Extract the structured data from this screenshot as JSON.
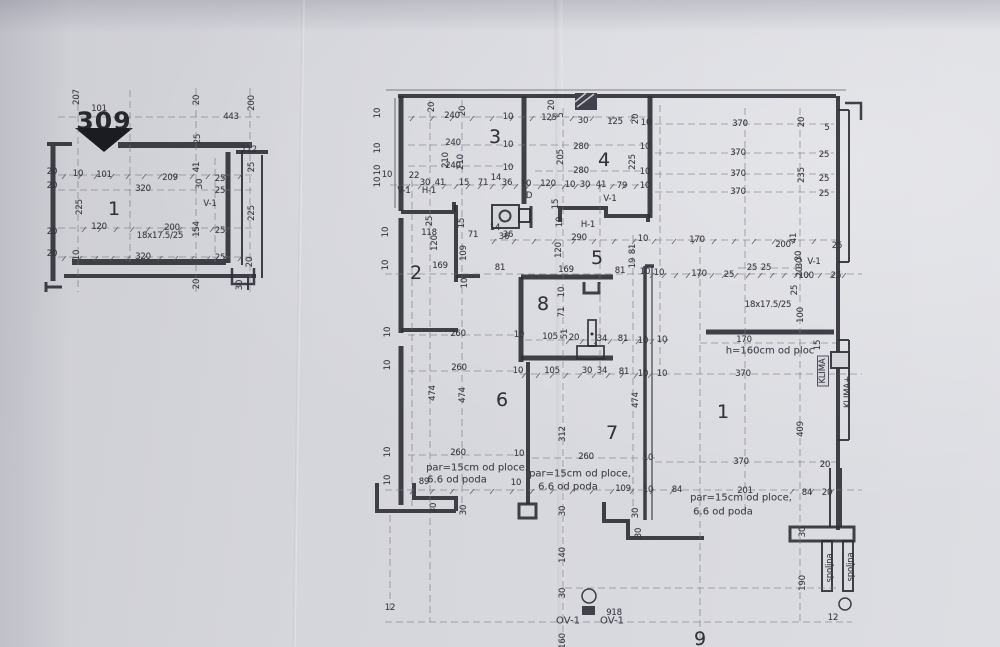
{
  "meta": {
    "document_type": "scanned architectural floor plan",
    "section_mark": "309",
    "paper_color": "#d5d6db",
    "ink_color": "#2d2d35"
  },
  "small_plan": {
    "room_numbers": [
      "1"
    ],
    "shaft_label": "V-1",
    "beam_note": "18x17.5/25"
  },
  "main_plan": {
    "room_numbers": [
      "1",
      "2",
      "3",
      "4",
      "5",
      "6",
      "7",
      "8",
      "9"
    ],
    "vent_labels": [
      "V-1",
      "H-1",
      "OV-1",
      "D"
    ],
    "notes": [
      "par=15cm od ploce.",
      "6.6 od poda",
      "h=160cm od ploc",
      "18x17.5/25"
    ],
    "equipment": [
      "KLIMA",
      "KLIMA+",
      "spoljna"
    ]
  },
  "labels": [
    {
      "t": "207",
      "x": 77,
      "y": 97,
      "r": 1
    },
    {
      "t": "101",
      "x": 99,
      "y": 109
    },
    {
      "t": "309",
      "x": 104,
      "y": 121,
      "k": "b"
    },
    {
      "t": "20",
      "x": 197,
      "y": 100,
      "r": 1
    },
    {
      "t": "443",
      "x": 231,
      "y": 117
    },
    {
      "t": "200",
      "x": 252,
      "y": 103,
      "r": 1
    },
    {
      "t": "25",
      "x": 198,
      "y": 139,
      "r": 1
    },
    {
      "t": "112",
      "x": 249,
      "y": 150
    },
    {
      "t": "25",
      "x": 252,
      "y": 167,
      "r": 1
    },
    {
      "t": "41",
      "x": 197,
      "y": 167,
      "r": 1
    },
    {
      "t": "20",
      "x": 52,
      "y": 172
    },
    {
      "t": "10",
      "x": 78,
      "y": 174
    },
    {
      "t": "101",
      "x": 104,
      "y": 175
    },
    {
      "t": "209",
      "x": 170,
      "y": 178
    },
    {
      "t": "25",
      "x": 220,
      "y": 179
    },
    {
      "t": "30",
      "x": 200,
      "y": 184,
      "r": 1
    },
    {
      "t": "20",
      "x": 52,
      "y": 186
    },
    {
      "t": "320",
      "x": 143,
      "y": 189
    },
    {
      "t": "25",
      "x": 220,
      "y": 191
    },
    {
      "t": "V-1",
      "x": 210,
      "y": 204
    },
    {
      "t": "225",
      "x": 80,
      "y": 207,
      "r": 1
    },
    {
      "t": "1",
      "x": 114,
      "y": 209,
      "k": "r"
    },
    {
      "t": "225",
      "x": 252,
      "y": 213,
      "r": 1
    },
    {
      "t": "20",
      "x": 52,
      "y": 232
    },
    {
      "t": "120",
      "x": 99,
      "y": 227
    },
    {
      "t": "200",
      "x": 172,
      "y": 228
    },
    {
      "t": "154",
      "x": 197,
      "y": 229,
      "r": 1
    },
    {
      "t": "18x17.5/25",
      "x": 160,
      "y": 236
    },
    {
      "t": "25",
      "x": 220,
      "y": 231
    },
    {
      "t": "20",
      "x": 52,
      "y": 254
    },
    {
      "t": "10",
      "x": 77,
      "y": 255,
      "r": 1
    },
    {
      "t": "320",
      "x": 143,
      "y": 257
    },
    {
      "t": "25",
      "x": 220,
      "y": 258
    },
    {
      "t": "20",
      "x": 250,
      "y": 262,
      "r": 1
    },
    {
      "t": "20",
      "x": 197,
      "y": 284,
      "r": 1
    },
    {
      "t": "30",
      "x": 240,
      "y": 285,
      "r": 1
    },
    {
      "t": "10",
      "x": 378,
      "y": 113,
      "r": 1
    },
    {
      "t": "10",
      "x": 378,
      "y": 148,
      "r": 1
    },
    {
      "t": "10",
      "x": 378,
      "y": 170,
      "r": 1
    },
    {
      "t": "10",
      "x": 378,
      "y": 182,
      "r": 1
    },
    {
      "t": "20",
      "x": 432,
      "y": 107,
      "r": 1
    },
    {
      "t": "240",
      "x": 452,
      "y": 116
    },
    {
      "t": "20",
      "x": 463,
      "y": 111,
      "r": 1
    },
    {
      "t": "10",
      "x": 508,
      "y": 117
    },
    {
      "t": "20",
      "x": 552,
      "y": 105,
      "r": 1
    },
    {
      "t": "125",
      "x": 549,
      "y": 118
    },
    {
      "t": "5",
      "x": 561,
      "y": 115,
      "r": 1
    },
    {
      "t": "30",
      "x": 583,
      "y": 121
    },
    {
      "t": "125",
      "x": 615,
      "y": 122
    },
    {
      "t": "20",
      "x": 636,
      "y": 119,
      "r": 1
    },
    {
      "t": "10",
      "x": 646,
      "y": 123
    },
    {
      "t": "370",
      "x": 740,
      "y": 124
    },
    {
      "t": "20",
      "x": 802,
      "y": 122,
      "r": 1
    },
    {
      "t": "5",
      "x": 827,
      "y": 128
    },
    {
      "t": "3",
      "x": 495,
      "y": 137,
      "k": "r"
    },
    {
      "t": "240",
      "x": 453,
      "y": 143
    },
    {
      "t": "10",
      "x": 508,
      "y": 145
    },
    {
      "t": "280",
      "x": 581,
      "y": 147
    },
    {
      "t": "10",
      "x": 645,
      "y": 147
    },
    {
      "t": "370",
      "x": 738,
      "y": 153
    },
    {
      "t": "25",
      "x": 824,
      "y": 155
    },
    {
      "t": "4",
      "x": 604,
      "y": 160,
      "k": "r"
    },
    {
      "t": "210",
      "x": 446,
      "y": 160,
      "r": 1
    },
    {
      "t": "240",
      "x": 453,
      "y": 166
    },
    {
      "t": "210",
      "x": 461,
      "y": 162,
      "r": 1
    },
    {
      "t": "10",
      "x": 508,
      "y": 168
    },
    {
      "t": "205",
      "x": 561,
      "y": 157,
      "r": 1
    },
    {
      "t": "225",
      "x": 633,
      "y": 162,
      "r": 1
    },
    {
      "t": "280",
      "x": 581,
      "y": 171
    },
    {
      "t": "10",
      "x": 645,
      "y": 172
    },
    {
      "t": "370",
      "x": 738,
      "y": 174
    },
    {
      "t": "235",
      "x": 802,
      "y": 175,
      "r": 1
    },
    {
      "t": "25",
      "x": 824,
      "y": 179
    },
    {
      "t": "10",
      "x": 387,
      "y": 175
    },
    {
      "t": "22",
      "x": 414,
      "y": 176
    },
    {
      "t": "30",
      "x": 425,
      "y": 183
    },
    {
      "t": "41",
      "x": 440,
      "y": 183
    },
    {
      "t": "15",
      "x": 464,
      "y": 183
    },
    {
      "t": "71",
      "x": 483,
      "y": 183
    },
    {
      "t": "14",
      "x": 496,
      "y": 178
    },
    {
      "t": "36",
      "x": 507,
      "y": 183
    },
    {
      "t": "10",
      "x": 526,
      "y": 184
    },
    {
      "t": "120",
      "x": 548,
      "y": 184
    },
    {
      "t": "10",
      "x": 570,
      "y": 185
    },
    {
      "t": "30",
      "x": 585,
      "y": 185
    },
    {
      "t": "41",
      "x": 601,
      "y": 185
    },
    {
      "t": "79",
      "x": 622,
      "y": 186
    },
    {
      "t": "10",
      "x": 645,
      "y": 186
    },
    {
      "t": "370",
      "x": 738,
      "y": 192
    },
    {
      "t": "25",
      "x": 824,
      "y": 194
    },
    {
      "t": "V-1",
      "x": 404,
      "y": 191
    },
    {
      "t": "H-1",
      "x": 429,
      "y": 191
    },
    {
      "t": "D",
      "x": 529,
      "y": 196
    },
    {
      "t": "V-1",
      "x": 610,
      "y": 199
    },
    {
      "t": "15",
      "x": 556,
      "y": 204,
      "r": 1
    },
    {
      "t": "25",
      "x": 430,
      "y": 221,
      "r": 1
    },
    {
      "t": "15",
      "x": 462,
      "y": 223,
      "r": 1
    },
    {
      "t": "118",
      "x": 429,
      "y": 233
    },
    {
      "t": "71",
      "x": 473,
      "y": 235
    },
    {
      "t": "14",
      "x": 495,
      "y": 228
    },
    {
      "t": "36",
      "x": 508,
      "y": 235
    },
    {
      "t": "10",
      "x": 560,
      "y": 222,
      "r": 1
    },
    {
      "t": "H-1",
      "x": 588,
      "y": 225
    },
    {
      "t": "36",
      "x": 504,
      "y": 237
    },
    {
      "t": "290",
      "x": 579,
      "y": 238
    },
    {
      "t": "10",
      "x": 643,
      "y": 239
    },
    {
      "t": "170",
      "x": 697,
      "y": 240
    },
    {
      "t": "41",
      "x": 794,
      "y": 238,
      "r": 1
    },
    {
      "t": "200",
      "x": 783,
      "y": 245
    },
    {
      "t": "25",
      "x": 837,
      "y": 246
    },
    {
      "t": "30",
      "x": 799,
      "y": 256,
      "r": 1
    },
    {
      "t": "V-1",
      "x": 814,
      "y": 262
    },
    {
      "t": "120",
      "x": 435,
      "y": 243,
      "r": 1
    },
    {
      "t": "109",
      "x": 464,
      "y": 253,
      "r": 1
    },
    {
      "t": "120",
      "x": 559,
      "y": 250,
      "r": 1
    },
    {
      "t": "5",
      "x": 597,
      "y": 258,
      "k": "r"
    },
    {
      "t": "81",
      "x": 633,
      "y": 249,
      "r": 1
    },
    {
      "t": "19",
      "x": 633,
      "y": 263,
      "r": 1
    },
    {
      "t": "2",
      "x": 416,
      "y": 273,
      "k": "r"
    },
    {
      "t": "169",
      "x": 440,
      "y": 266
    },
    {
      "t": "81",
      "x": 500,
      "y": 268
    },
    {
      "t": "169",
      "x": 566,
      "y": 270
    },
    {
      "t": "81",
      "x": 620,
      "y": 271
    },
    {
      "t": "10",
      "x": 645,
      "y": 272
    },
    {
      "t": "10",
      "x": 659,
      "y": 273
    },
    {
      "t": "170",
      "x": 699,
      "y": 274
    },
    {
      "t": "25",
      "x": 729,
      "y": 275
    },
    {
      "t": "25",
      "x": 752,
      "y": 268
    },
    {
      "t": "25",
      "x": 766,
      "y": 268
    },
    {
      "t": "30",
      "x": 800,
      "y": 263,
      "r": 1
    },
    {
      "t": "20",
      "x": 800,
      "y": 272,
      "r": 1
    },
    {
      "t": "100",
      "x": 806,
      "y": 276
    },
    {
      "t": "25",
      "x": 836,
      "y": 276
    },
    {
      "t": "10",
      "x": 465,
      "y": 283,
      "r": 1
    },
    {
      "t": "10",
      "x": 386,
      "y": 232,
      "r": 1
    },
    {
      "t": "10",
      "x": 386,
      "y": 265,
      "r": 1
    },
    {
      "t": "10",
      "x": 388,
      "y": 332,
      "r": 1
    },
    {
      "t": "8",
      "x": 543,
      "y": 304,
      "k": "r"
    },
    {
      "t": "10",
      "x": 562,
      "y": 292,
      "r": 1
    },
    {
      "t": "71",
      "x": 562,
      "y": 312,
      "r": 1
    },
    {
      "t": "18x17.5/25",
      "x": 768,
      "y": 305
    },
    {
      "t": "25",
      "x": 795,
      "y": 290,
      "r": 1
    },
    {
      "t": "100",
      "x": 801,
      "y": 315,
      "r": 1
    },
    {
      "t": "260",
      "x": 458,
      "y": 334
    },
    {
      "t": "10",
      "x": 519,
      "y": 335
    },
    {
      "t": "105",
      "x": 550,
      "y": 337
    },
    {
      "t": "51",
      "x": 565,
      "y": 334,
      "r": 1
    },
    {
      "t": "20",
      "x": 574,
      "y": 338
    },
    {
      "t": "34",
      "x": 602,
      "y": 339
    },
    {
      "t": "81",
      "x": 623,
      "y": 339
    },
    {
      "t": "10",
      "x": 643,
      "y": 341
    },
    {
      "t": "10",
      "x": 662,
      "y": 340
    },
    {
      "t": "170",
      "x": 744,
      "y": 340
    },
    {
      "t": "h=160cm od ploc",
      "x": 770,
      "y": 351,
      "k": "a"
    },
    {
      "t": "15",
      "x": 818,
      "y": 345,
      "r": 1
    },
    {
      "t": "KLIMA",
      "x": 823,
      "y": 371,
      "r": 1,
      "k": "x"
    },
    {
      "t": "KLIMA+",
      "x": 848,
      "y": 392,
      "r": 1
    },
    {
      "t": "260",
      "x": 459,
      "y": 368
    },
    {
      "t": "10",
      "x": 518,
      "y": 371
    },
    {
      "t": "105",
      "x": 552,
      "y": 371
    },
    {
      "t": "30",
      "x": 587,
      "y": 371
    },
    {
      "t": "34",
      "x": 602,
      "y": 371
    },
    {
      "t": "81",
      "x": 624,
      "y": 372
    },
    {
      "t": "10",
      "x": 643,
      "y": 374
    },
    {
      "t": "10",
      "x": 662,
      "y": 374
    },
    {
      "t": "370",
      "x": 743,
      "y": 374
    },
    {
      "t": "474",
      "x": 433,
      "y": 393,
      "r": 1
    },
    {
      "t": "474",
      "x": 463,
      "y": 395,
      "r": 1
    },
    {
      "t": "6",
      "x": 502,
      "y": 400,
      "k": "r"
    },
    {
      "t": "474",
      "x": 636,
      "y": 400,
      "r": 1
    },
    {
      "t": "1",
      "x": 723,
      "y": 412,
      "k": "r"
    },
    {
      "t": "409",
      "x": 801,
      "y": 429,
      "r": 1
    },
    {
      "t": "312",
      "x": 563,
      "y": 434,
      "r": 1
    },
    {
      "t": "7",
      "x": 612,
      "y": 433,
      "k": "r"
    },
    {
      "t": "370",
      "x": 741,
      "y": 462
    },
    {
      "t": "10",
      "x": 388,
      "y": 365,
      "r": 1
    },
    {
      "t": "10",
      "x": 388,
      "y": 452,
      "r": 1
    },
    {
      "t": "10",
      "x": 388,
      "y": 480,
      "r": 1
    },
    {
      "t": "260",
      "x": 458,
      "y": 453
    },
    {
      "t": "10",
      "x": 519,
      "y": 454
    },
    {
      "t": "260",
      "x": 586,
      "y": 457
    },
    {
      "t": "10",
      "x": 648,
      "y": 458
    },
    {
      "t": "par=15cm od ploce.",
      "x": 477,
      "y": 468,
      "k": "a"
    },
    {
      "t": "6.6 od poda",
      "x": 457,
      "y": 480,
      "k": "a"
    },
    {
      "t": "89",
      "x": 424,
      "y": 482
    },
    {
      "t": "10",
      "x": 516,
      "y": 483
    },
    {
      "t": "par=15cm od ploce,",
      "x": 580,
      "y": 474,
      "k": "a"
    },
    {
      "t": "6.6 od poda",
      "x": 568,
      "y": 487,
      "k": "a"
    },
    {
      "t": "109",
      "x": 623,
      "y": 489
    },
    {
      "t": "10",
      "x": 648,
      "y": 490
    },
    {
      "t": "84",
      "x": 677,
      "y": 490
    },
    {
      "t": "201",
      "x": 745,
      "y": 491
    },
    {
      "t": "par=15cm od ploce,",
      "x": 741,
      "y": 498,
      "k": "a"
    },
    {
      "t": "6.6 od poda",
      "x": 723,
      "y": 512,
      "k": "a"
    },
    {
      "t": "84",
      "x": 807,
      "y": 493
    },
    {
      "t": "20",
      "x": 827,
      "y": 493
    },
    {
      "t": "20",
      "x": 825,
      "y": 465
    },
    {
      "t": "30",
      "x": 434,
      "y": 508,
      "r": 1
    },
    {
      "t": "30",
      "x": 464,
      "y": 510,
      "r": 1
    },
    {
      "t": "30",
      "x": 563,
      "y": 511,
      "r": 1
    },
    {
      "t": "30",
      "x": 636,
      "y": 513,
      "r": 1
    },
    {
      "t": "30",
      "x": 639,
      "y": 533,
      "r": 1
    },
    {
      "t": "30",
      "x": 803,
      "y": 532,
      "r": 1
    },
    {
      "t": "140",
      "x": 563,
      "y": 555,
      "r": 1
    },
    {
      "t": "30",
      "x": 563,
      "y": 593,
      "r": 1
    },
    {
      "t": "918",
      "x": 614,
      "y": 613
    },
    {
      "t": "OV-1",
      "x": 568,
      "y": 621,
      "k": "a"
    },
    {
      "t": "OV-1",
      "x": 612,
      "y": 621,
      "k": "a"
    },
    {
      "t": "9",
      "x": 700,
      "y": 639,
      "k": "r"
    },
    {
      "t": "160",
      "x": 563,
      "y": 641,
      "r": 1
    },
    {
      "t": "190",
      "x": 803,
      "y": 583,
      "r": 1
    },
    {
      "t": "spoljna",
      "x": 830,
      "y": 568,
      "r": 1
    },
    {
      "t": "spoljna",
      "x": 851,
      "y": 567,
      "r": 1
    },
    {
      "t": "12",
      "x": 833,
      "y": 618
    },
    {
      "t": "12",
      "x": 390,
      "y": 608
    }
  ]
}
